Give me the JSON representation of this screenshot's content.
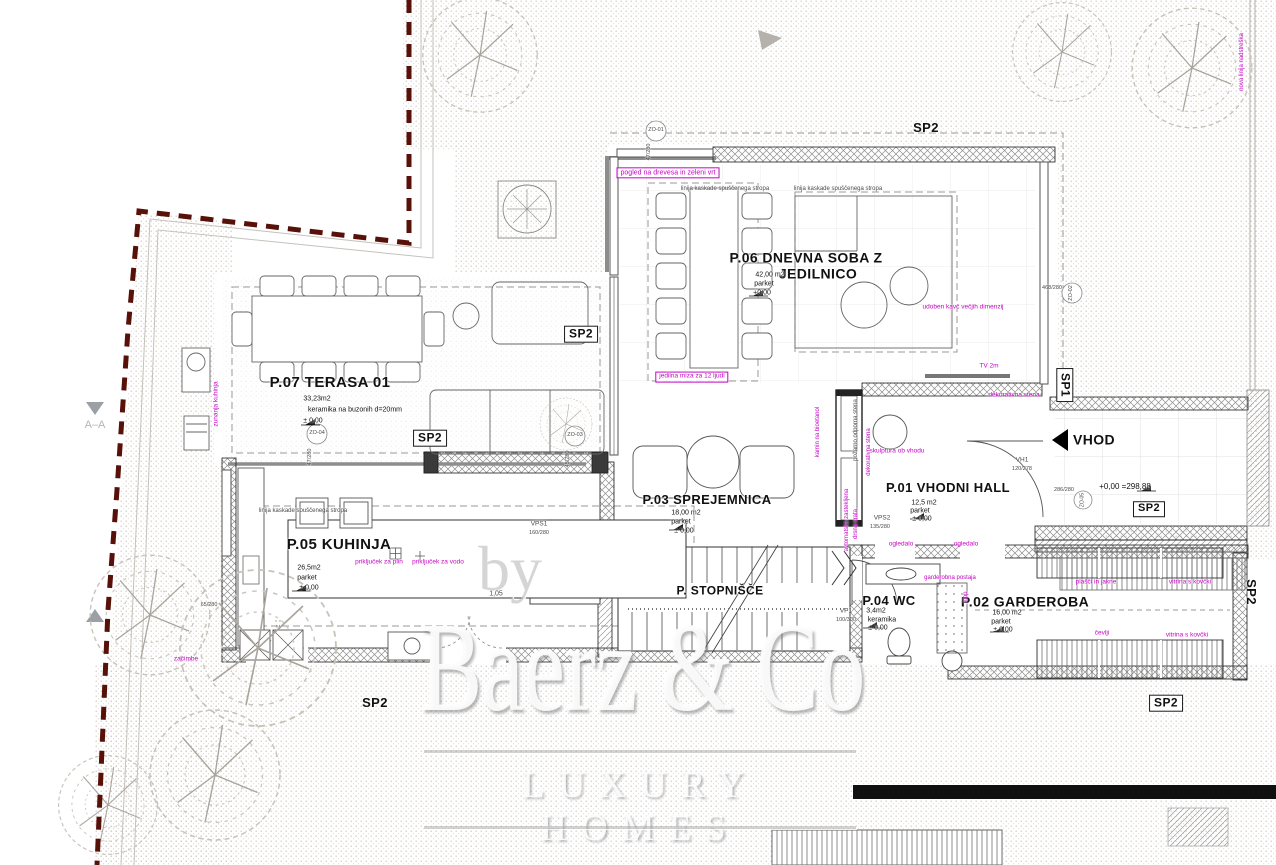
{
  "watermark": {
    "by": "by",
    "brand": "Baerz & Co",
    "tagline": "LUXURY HOMES"
  },
  "plan": {
    "labels": [
      {
        "n": "room-title-terasa",
        "t": "P.07 TERASA 01",
        "x": 330,
        "y": 383,
        "fs": 15,
        "b": true
      },
      {
        "n": "room-title-dnevna-1",
        "t": "P.06 DNEVNA SOBA Z",
        "x": 806,
        "y": 258,
        "fs": 14,
        "b": true
      },
      {
        "n": "room-title-dnevna-2",
        "t": "JEDILNICO",
        "x": 818,
        "y": 274,
        "fs": 14,
        "b": true
      },
      {
        "n": "room-title-kuhinja",
        "t": "P.05 KUHINJA",
        "x": 339,
        "y": 545,
        "fs": 15,
        "b": true
      },
      {
        "n": "room-title-sprejemnica",
        "t": "P.03 SPREJEMNICA",
        "x": 707,
        "y": 500,
        "fs": 13,
        "b": true
      },
      {
        "n": "room-title-hall",
        "t": "P.01 VHODNI HALL",
        "x": 948,
        "y": 488,
        "fs": 13,
        "b": true
      },
      {
        "n": "room-title-wc",
        "t": "P.04 WC",
        "x": 889,
        "y": 601,
        "fs": 13,
        "b": true
      },
      {
        "n": "room-title-garderoba",
        "t": "P.02 GARDEROBA",
        "x": 1025,
        "y": 602,
        "fs": 14,
        "b": true
      },
      {
        "n": "room-title-stopnisce",
        "t": "P. STOPNIŠČE",
        "x": 720,
        "y": 591,
        "fs": 12,
        "b": true
      },
      {
        "n": "vhod-label",
        "t": "VHOD",
        "x": 1094,
        "y": 440,
        "fs": 14,
        "b": true
      },
      {
        "n": "terasa-area",
        "t": "33,23m2",
        "x": 317,
        "y": 399,
        "fs": 7
      },
      {
        "n": "terasa-floor",
        "t": "keramika na buzonih d=20mm",
        "x": 355,
        "y": 410,
        "fs": 7
      },
      {
        "n": "terasa-level",
        "t": "± 0,00",
        "x": 313,
        "y": 421,
        "fs": 7
      },
      {
        "n": "dnevna-area",
        "t": "42,00 m2",
        "x": 770,
        "y": 275,
        "fs": 7
      },
      {
        "n": "dnevna-floor",
        "t": "parket",
        "x": 764,
        "y": 284,
        "fs": 7
      },
      {
        "n": "dnevna-level",
        "t": "+0,00",
        "x": 762,
        "y": 293,
        "fs": 7
      },
      {
        "n": "kuhinja-area",
        "t": "26,5m2",
        "x": 309,
        "y": 568,
        "fs": 7
      },
      {
        "n": "kuhinja-floor",
        "t": "parket",
        "x": 307,
        "y": 578,
        "fs": 7
      },
      {
        "n": "kuhinja-level",
        "t": "± 0,00",
        "x": 309,
        "y": 588,
        "fs": 7
      },
      {
        "n": "sprejemnica-area",
        "t": "18,00 m2",
        "x": 686,
        "y": 513,
        "fs": 7
      },
      {
        "n": "sprejemnica-floor",
        "t": "parket",
        "x": 681,
        "y": 522,
        "fs": 7
      },
      {
        "n": "sprejemnica-level",
        "t": "± 0,00",
        "x": 684,
        "y": 531,
        "fs": 7
      },
      {
        "n": "hall-area",
        "t": "12,5 m2",
        "x": 924,
        "y": 503,
        "fs": 7
      },
      {
        "n": "hall-floor",
        "t": "parket",
        "x": 920,
        "y": 511,
        "fs": 7
      },
      {
        "n": "hall-level",
        "t": "± 0,00",
        "x": 922,
        "y": 519,
        "fs": 7
      },
      {
        "n": "wc-area",
        "t": "3,4m2",
        "x": 876,
        "y": 611,
        "fs": 7
      },
      {
        "n": "wc-floor",
        "t": "keramika",
        "x": 882,
        "y": 620,
        "fs": 7
      },
      {
        "n": "wc-level",
        "t": "± 0,00",
        "x": 878,
        "y": 628,
        "fs": 7
      },
      {
        "n": "garderoba-area",
        "t": "16,00 m2",
        "x": 1007,
        "y": 613,
        "fs": 7
      },
      {
        "n": "garderoba-floor",
        "t": "parket",
        "x": 1001,
        "y": 622,
        "fs": 7
      },
      {
        "n": "garderoba-level",
        "t": "± 0,00",
        "x": 1003,
        "y": 630,
        "fs": 7
      },
      {
        "n": "entry-level",
        "t": "+0,00 =298,88",
        "x": 1125,
        "y": 487,
        "fs": 8
      },
      {
        "n": "sp2-top",
        "t": "SP2",
        "x": 926,
        "y": 128,
        "fs": 13,
        "b": true
      },
      {
        "n": "sp2-terrace-upper",
        "t": "SP2",
        "x": 581,
        "y": 334,
        "fs": 12,
        "b": true,
        "box": "k"
      },
      {
        "n": "sp2-terrace-lower",
        "t": "SP2",
        "x": 430,
        "y": 438,
        "fs": 12,
        "b": true,
        "box": "k"
      },
      {
        "n": "sp2-bottom-left",
        "t": "SP2",
        "x": 375,
        "y": 703,
        "fs": 13,
        "b": true
      },
      {
        "n": "sp2-entry",
        "t": "SP2",
        "x": 1149,
        "y": 509,
        "fs": 11,
        "b": true,
        "box": "k"
      },
      {
        "n": "sp1-right",
        "t": "SP1",
        "x": 1065,
        "y": 385,
        "fs": 12,
        "b": true,
        "box": "k",
        "r": 90
      },
      {
        "n": "sp2-right-rot",
        "t": "SP2",
        "x": 1251,
        "y": 592,
        "fs": 13,
        "b": true,
        "r": 90
      },
      {
        "n": "sp2-bottom-right",
        "t": "SP2",
        "x": 1166,
        "y": 703,
        "fs": 12,
        "b": true,
        "box": "k"
      },
      {
        "n": "section-aa",
        "t": "A–A",
        "x": 95,
        "y": 426,
        "fs": 11,
        "c": "g"
      },
      {
        "n": "note-pogled",
        "t": "pogled na drevesa in zeleni vrt",
        "x": 668,
        "y": 173,
        "fs": 7,
        "c": "m",
        "box": "m"
      },
      {
        "n": "note-kaskada-1",
        "t": "linija kaskade spuščenega stropa",
        "x": 725,
        "y": 189,
        "fs": 6,
        "c": "d"
      },
      {
        "n": "note-kaskada-2",
        "t": "linija kaskade spuščenega stropa",
        "x": 838,
        "y": 189,
        "fs": 6,
        "c": "d"
      },
      {
        "n": "note-kaskada-3",
        "t": "linija kaskade spuščenega stropa",
        "x": 303,
        "y": 511,
        "fs": 6,
        "c": "d"
      },
      {
        "n": "note-jedilna-miza",
        "t": "jedilna miza za 12 ljudi",
        "x": 692,
        "y": 377,
        "fs": 6.5,
        "c": "m",
        "box": "m"
      },
      {
        "n": "note-kavc",
        "t": "udoben kavč večjih dimenzij",
        "x": 963,
        "y": 308,
        "fs": 6.5,
        "c": "m"
      },
      {
        "n": "note-tv",
        "t": "TV 2m",
        "x": 989,
        "y": 367,
        "fs": 6.5,
        "c": "m"
      },
      {
        "n": "note-dekorativna-1",
        "t": "dekorativna stena",
        "x": 1014,
        "y": 396,
        "fs": 6.5,
        "c": "m"
      },
      {
        "n": "note-dekorativna-2",
        "t": "dekorativna stena",
        "x": 869,
        "y": 452,
        "fs": 6,
        "c": "m",
        "r": -90
      },
      {
        "n": "note-kamin",
        "t": "kamin na bioetanol",
        "x": 818,
        "y": 432,
        "fs": 6,
        "c": "m",
        "r": -90
      },
      {
        "n": "note-pozarno",
        "t": "požarno odporna stena",
        "x": 856,
        "y": 430,
        "fs": 6,
        "c": "d",
        "r": -90
      },
      {
        "n": "note-skulptura",
        "t": "skulptura ob vhodu",
        "x": 897,
        "y": 452,
        "fs": 6.5,
        "c": "m"
      },
      {
        "n": "note-avtomatska",
        "t": "avtomatska zastekljena",
        "x": 847,
        "y": 520,
        "fs": 6,
        "c": "m",
        "r": -90
      },
      {
        "n": "note-drsna",
        "t": "drsna vrata",
        "x": 856,
        "y": 524,
        "fs": 6,
        "c": "m",
        "r": -90
      },
      {
        "n": "note-ogledalo-1",
        "t": "ogledalo",
        "x": 901,
        "y": 545,
        "fs": 6.5,
        "c": "m"
      },
      {
        "n": "note-ogledalo-2",
        "t": "ogledalo",
        "x": 966,
        "y": 545,
        "fs": 6.5,
        "c": "m"
      },
      {
        "n": "note-garderobna",
        "t": "garderobna postaja",
        "x": 950,
        "y": 578,
        "fs": 6,
        "c": "m"
      },
      {
        "n": "note-klop",
        "t": "klop",
        "x": 966,
        "y": 597,
        "fs": 6,
        "c": "m",
        "r": -90
      },
      {
        "n": "note-plasci",
        "t": "plašči in jakne",
        "x": 1096,
        "y": 583,
        "fs": 6.5,
        "c": "m"
      },
      {
        "n": "note-vitrina-1",
        "t": "vitrina s kovčki",
        "x": 1190,
        "y": 583,
        "fs": 6.5,
        "c": "m"
      },
      {
        "n": "note-cevlji",
        "t": "čevlji",
        "x": 1102,
        "y": 634,
        "fs": 6.5,
        "c": "m"
      },
      {
        "n": "note-vitrina-2",
        "t": "vitrina s kovčki",
        "x": 1187,
        "y": 636,
        "fs": 6.5,
        "c": "m"
      },
      {
        "n": "note-plin",
        "t": "priključek za plin",
        "x": 379,
        "y": 563,
        "fs": 6.5,
        "c": "m"
      },
      {
        "n": "note-voda",
        "t": "priključek za vodo",
        "x": 438,
        "y": 563,
        "fs": 6.5,
        "c": "m"
      },
      {
        "n": "note-zunanja-kuhinja",
        "t": "zunanja kuhinja",
        "x": 217,
        "y": 404,
        "fs": 6.5,
        "c": "m",
        "r": -90
      },
      {
        "n": "note-zacimbe",
        "t": "začimbe",
        "x": 186,
        "y": 660,
        "fs": 6.5,
        "c": "m"
      },
      {
        "n": "note-nova-linija",
        "t": "nova linija nadstreška",
        "x": 1242,
        "y": 62,
        "fs": 6,
        "c": "m",
        "r": -90
      },
      {
        "n": "dim-zo01",
        "t": "ZO-01",
        "x": 656,
        "y": 131,
        "fs": 5.5,
        "c": "d"
      },
      {
        "n": "dim-zo01-size",
        "t": "47/280",
        "x": 650,
        "y": 152,
        "fs": 5.5,
        "c": "d",
        "r": -90
      },
      {
        "n": "dim-zo04",
        "t": "ZO-04",
        "x": 317,
        "y": 434,
        "fs": 5.5,
        "c": "d"
      },
      {
        "n": "dim-zo04-size",
        "t": "47/280",
        "x": 311,
        "y": 457,
        "fs": 5.5,
        "c": "d",
        "r": -90
      },
      {
        "n": "dim-zo03",
        "t": "ZO-03",
        "x": 575,
        "y": 436,
        "fs": 5.5,
        "c": "d"
      },
      {
        "n": "dim-zo03-size",
        "t": "45/280",
        "x": 569,
        "y": 459,
        "fs": 5.5,
        "c": "d",
        "r": -90
      },
      {
        "n": "dim-zo02",
        "t": "ZO-02",
        "x": 1072,
        "y": 293,
        "fs": 5.5,
        "c": "d",
        "r": -90
      },
      {
        "n": "dim-zo02-size",
        "t": "468/280",
        "x": 1052,
        "y": 289,
        "fs": 5.5,
        "c": "d"
      },
      {
        "n": "dim-entry-door",
        "t": "286/280",
        "x": 1064,
        "y": 491,
        "fs": 5.5,
        "c": "d"
      },
      {
        "n": "dim-zo05",
        "t": "ZO-05",
        "x": 1083,
        "y": 500,
        "fs": 5,
        "c": "d",
        "r": -90
      },
      {
        "n": "dim-vps1",
        "t": "VPS1",
        "x": 539,
        "y": 525,
        "fs": 6.5,
        "c": "d"
      },
      {
        "n": "dim-vps1-size",
        "t": "160/280",
        "x": 539,
        "y": 534,
        "fs": 5.5,
        "c": "d"
      },
      {
        "n": "dim-vps2",
        "t": "VPS2",
        "x": 882,
        "y": 519,
        "fs": 6.5,
        "c": "d"
      },
      {
        "n": "dim-vps2-size",
        "t": "135/280",
        "x": 880,
        "y": 528,
        "fs": 5.5,
        "c": "d"
      },
      {
        "n": "dim-vh1",
        "t": "VH1",
        "x": 1022,
        "y": 461,
        "fs": 6.5,
        "c": "d"
      },
      {
        "n": "dim-vh1-size",
        "t": "120/278",
        "x": 1022,
        "y": 470,
        "fs": 5.5,
        "c": "d"
      },
      {
        "n": "dim-vp1",
        "t": "VP1",
        "x": 846,
        "y": 612,
        "fs": 6.5,
        "c": "d"
      },
      {
        "n": "dim-vp1-size",
        "t": "100/300",
        "x": 846,
        "y": 621,
        "fs": 5.5,
        "c": "d"
      },
      {
        "n": "dim-105",
        "t": "1,05",
        "x": 496,
        "y": 594,
        "fs": 7,
        "c": "d"
      },
      {
        "n": "dim-65-280",
        "t": "65/280",
        "x": 209,
        "y": 606,
        "fs": 5.5,
        "c": "d"
      }
    ]
  }
}
